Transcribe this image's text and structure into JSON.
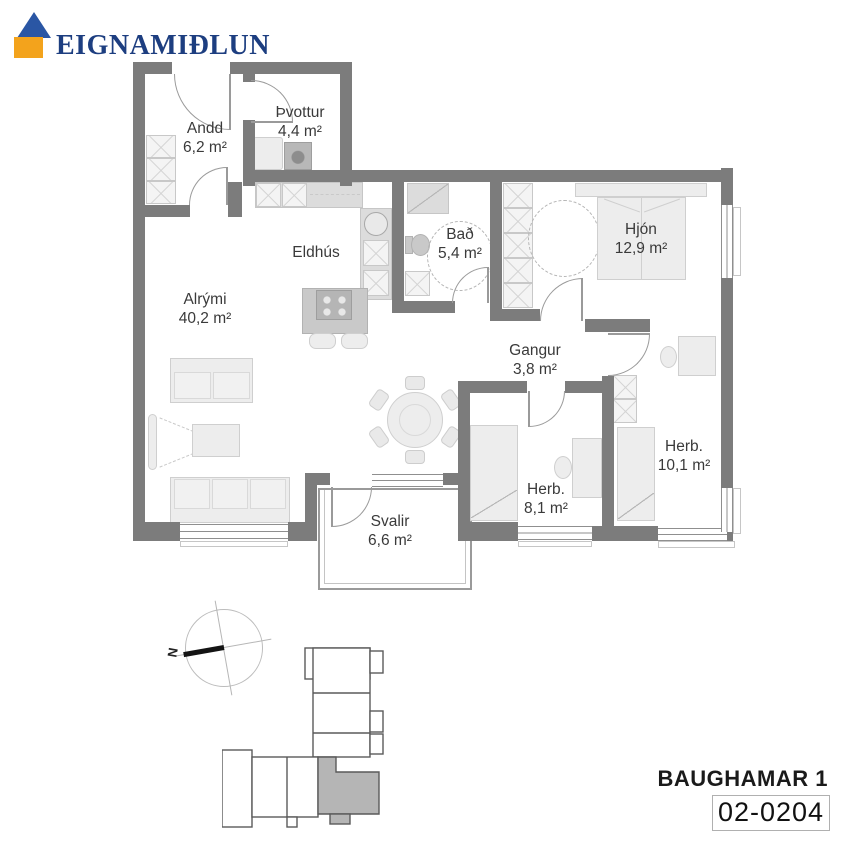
{
  "brand": {
    "name": "EIGNAMIÐLUN"
  },
  "plan": {
    "rooms": {
      "andd": {
        "name": "Andd",
        "area": "6,2 m²"
      },
      "thvottur": {
        "name": "Þvottur",
        "area": "4,4 m²"
      },
      "eldhus": {
        "name": "Eldhús",
        "area": ""
      },
      "bad": {
        "name": "Bað",
        "area": "5,4 m²"
      },
      "hjon": {
        "name": "Hjón",
        "area": "12,9 m²"
      },
      "alrymi": {
        "name": "Alrými",
        "area": "40,2 m²"
      },
      "gangur": {
        "name": "Gangur",
        "area": "3,8 m²"
      },
      "herb_small": {
        "name": "Herb.",
        "area": "8,1 m²"
      },
      "herb_large": {
        "name": "Herb.",
        "area": "10,1 m²"
      },
      "svalir": {
        "name": "Svalir",
        "area": "6,6 m²"
      }
    }
  },
  "compass": {
    "north_label": "N"
  },
  "footer": {
    "building": "BAUGHAMAR 1",
    "unit_id": "02-0204"
  },
  "colors": {
    "wall": "#7c7c7c",
    "logo_roof": "#2a56a4",
    "logo_body": "#f3a31c",
    "logo_text": "#1d3e80",
    "highlighted_unit": "#b5b5b5"
  }
}
